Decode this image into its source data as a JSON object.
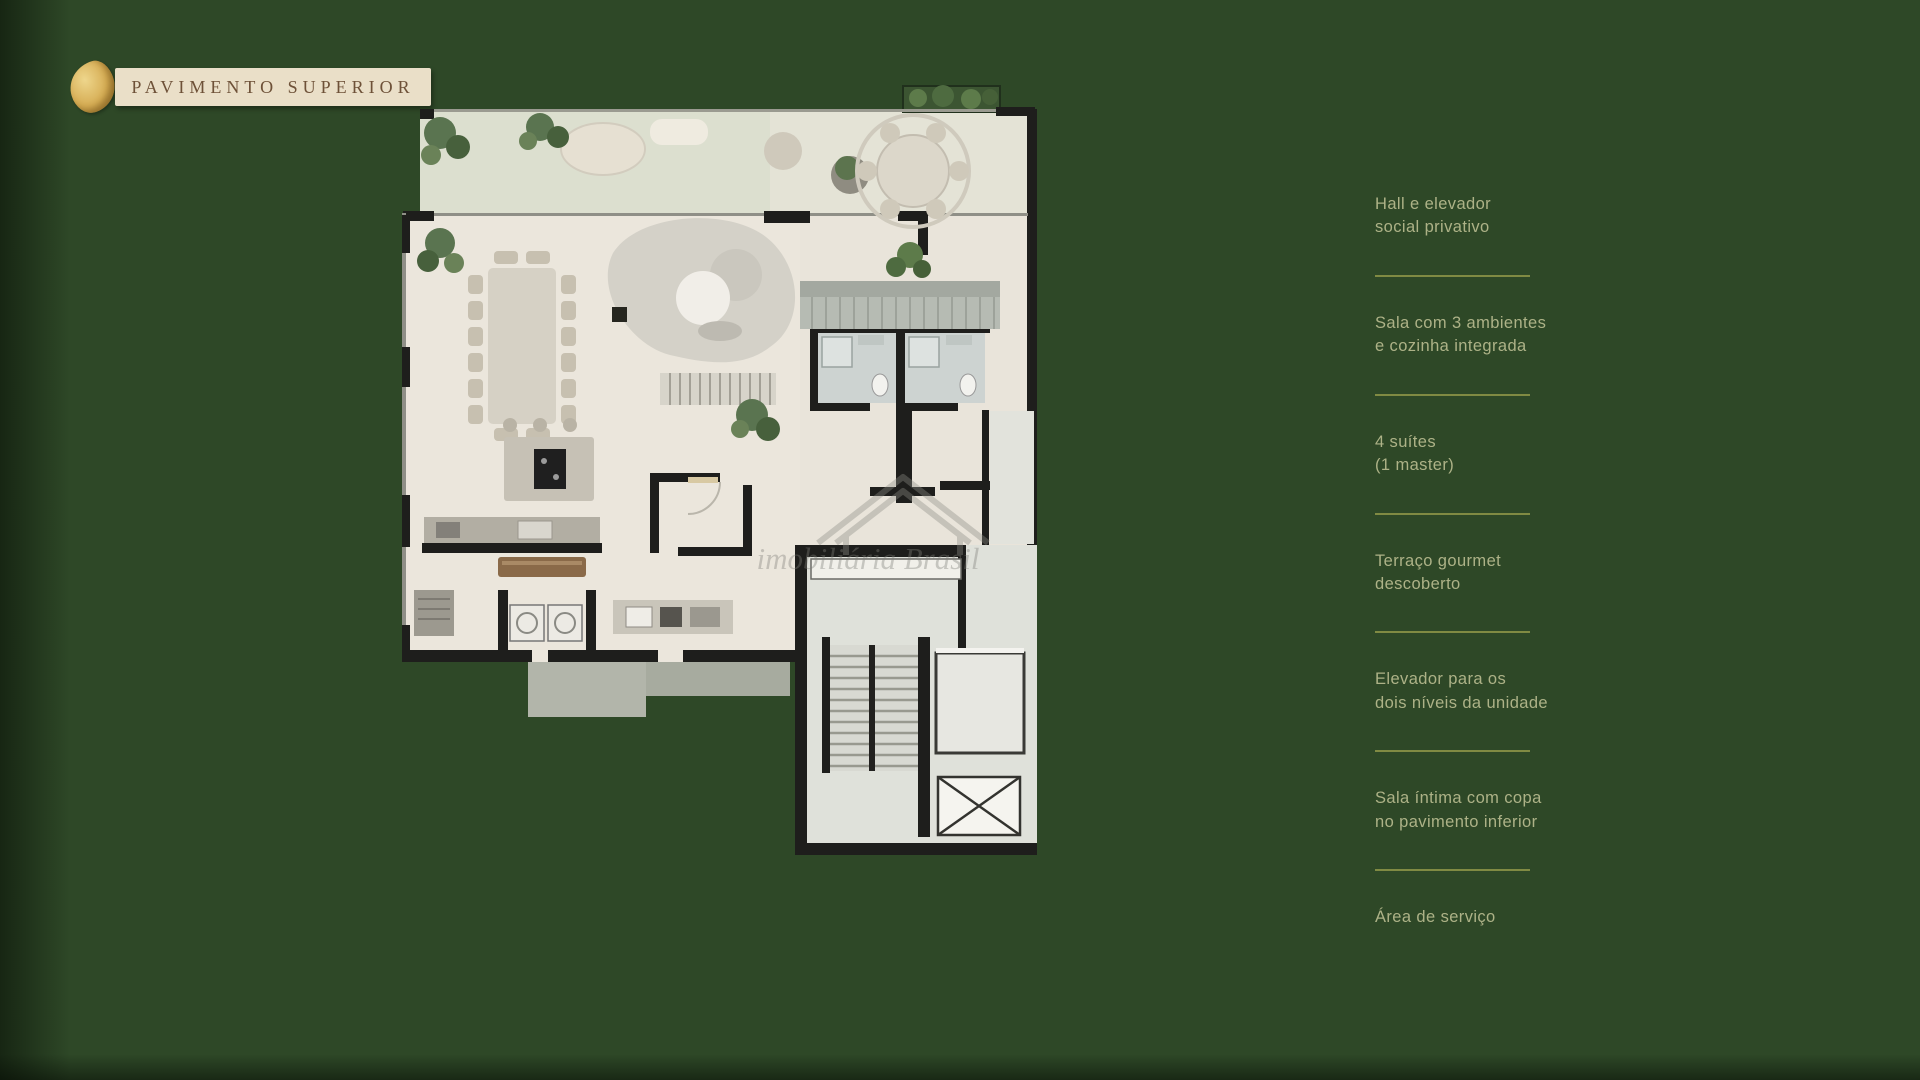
{
  "slide": {
    "title": "PAVIMENTO SUPERIOR",
    "background_color": "#2e4827",
    "banner": {
      "bg_color": "#eadfc8",
      "text_color": "#6e5138",
      "leaf_color": "#d6ad54"
    }
  },
  "features": {
    "text_color": "#adb287",
    "divider_color": "#8a9147",
    "items": [
      {
        "lines": [
          "Hall e elevador",
          "social privativo"
        ]
      },
      {
        "lines": [
          "Sala com 3 ambientes",
          "e cozinha integrada"
        ]
      },
      {
        "lines": [
          "4 suítes",
          "(1 master)"
        ]
      },
      {
        "lines": [
          "Terraço gourmet",
          "descoberto"
        ]
      },
      {
        "lines": [
          "Elevador para os",
          "dois níveis da unidade"
        ]
      },
      {
        "lines": [
          "Sala íntima com copa",
          "no pavimento inferior"
        ]
      },
      {
        "lines": [
          "Área de serviço"
        ]
      }
    ]
  },
  "floor_plan": {
    "watermark": "imobiliária Brasil",
    "floor_color": "#ebe6dc",
    "wall_color": "#1e1e1c"
  }
}
